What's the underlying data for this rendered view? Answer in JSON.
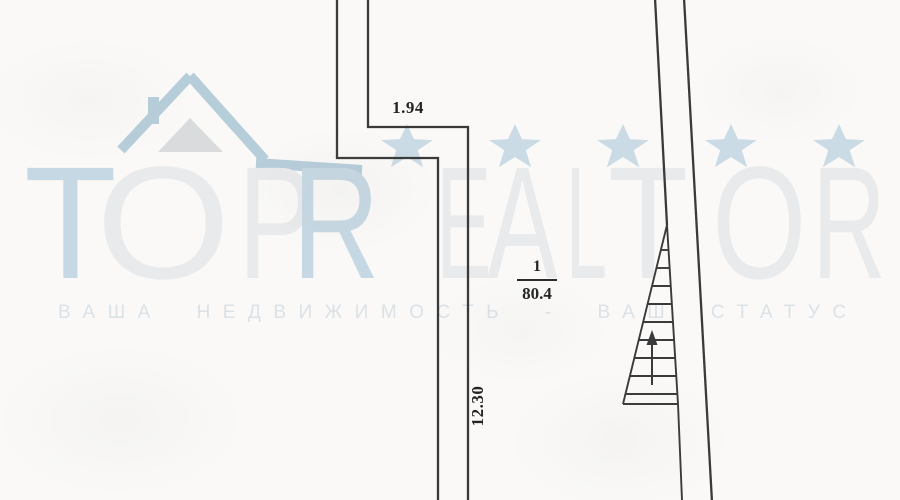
{
  "plan": {
    "dimensions": {
      "top_width": "1.94",
      "left_height": "12.30"
    },
    "room": {
      "number": "1",
      "area": "80.4"
    },
    "stairs": {
      "direction": "up",
      "tread_count": 9
    },
    "line_color": "#3a3a3a"
  },
  "watermark": {
    "brand": {
      "letters": [
        {
          "char": "T",
          "tone": "blue"
        },
        {
          "char": "O",
          "tone": "gray"
        },
        {
          "char": "P",
          "tone": "gray"
        },
        {
          "char": "R",
          "tone": "blue"
        },
        {
          "char": "E",
          "tone": "gray"
        },
        {
          "char": "A",
          "tone": "gray"
        },
        {
          "char": "L",
          "tone": "gray"
        },
        {
          "char": "T",
          "tone": "gray"
        },
        {
          "char": "O",
          "tone": "gray"
        },
        {
          "char": "R",
          "tone": "gray"
        }
      ]
    },
    "tagline": "ВАША НЕДВИЖИМОСТЬ - ВАШ СТАТУС",
    "stars_count": 5,
    "colors": {
      "accent_blue": "#c6d8e3",
      "light_gray": "#e8eaec",
      "star_blue": "#cbdbe5",
      "roof_blue": "#b6cdda",
      "gable_gray": "#d9dbdc"
    }
  }
}
